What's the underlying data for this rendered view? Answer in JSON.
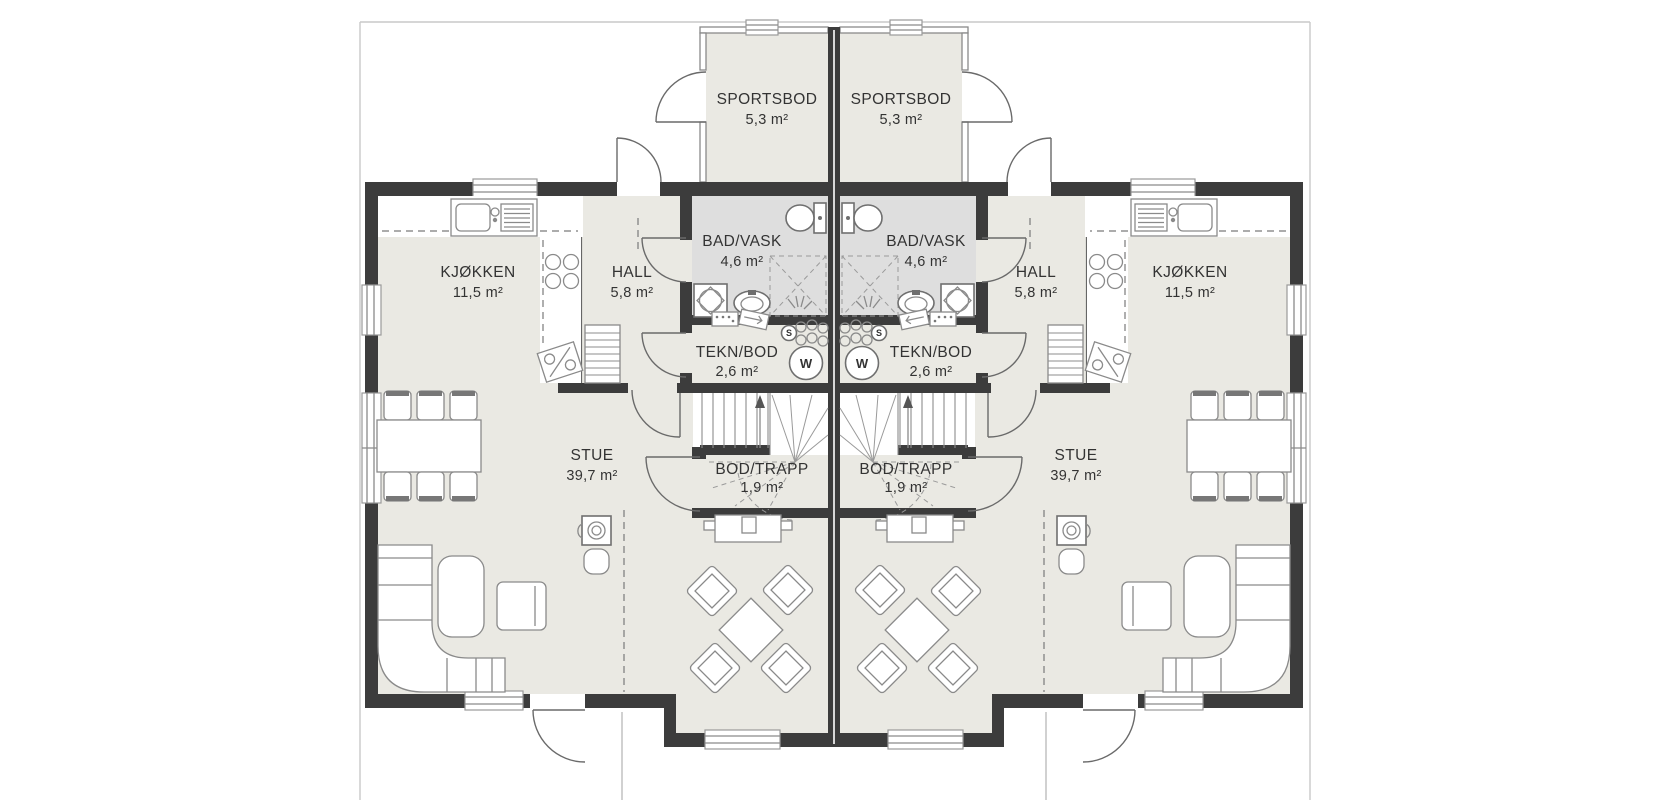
{
  "plan_type": "duplex-first-floor",
  "rooms": {
    "sportsbod": {
      "label": "SPORTSBOD",
      "area": "5,3 m²"
    },
    "badvask": {
      "label": "BAD/VASK",
      "area": "4,6 m²"
    },
    "hall": {
      "label": "HALL",
      "area": "5,8 m²"
    },
    "kjokken": {
      "label": "KJØKKEN",
      "area": "11,5 m²"
    },
    "teknbod": {
      "label": "TEKN/BOD",
      "area": "2,6 m²"
    },
    "bodtrapp": {
      "label": "BOD/TRAPP",
      "area": "1,9 m²"
    },
    "stue": {
      "label": "STUE",
      "area": "39,7 m²"
    }
  },
  "appliances": {
    "washer_label": "W",
    "sink_label": "S"
  },
  "colors": {
    "wall": "#3c3c3c",
    "floor": "#eae9e3",
    "bathroom_floor": "#dedede",
    "outline": "#8a8a8a",
    "plot_line": "#c9c9c9",
    "text": "#333333",
    "background": "#ffffff"
  }
}
